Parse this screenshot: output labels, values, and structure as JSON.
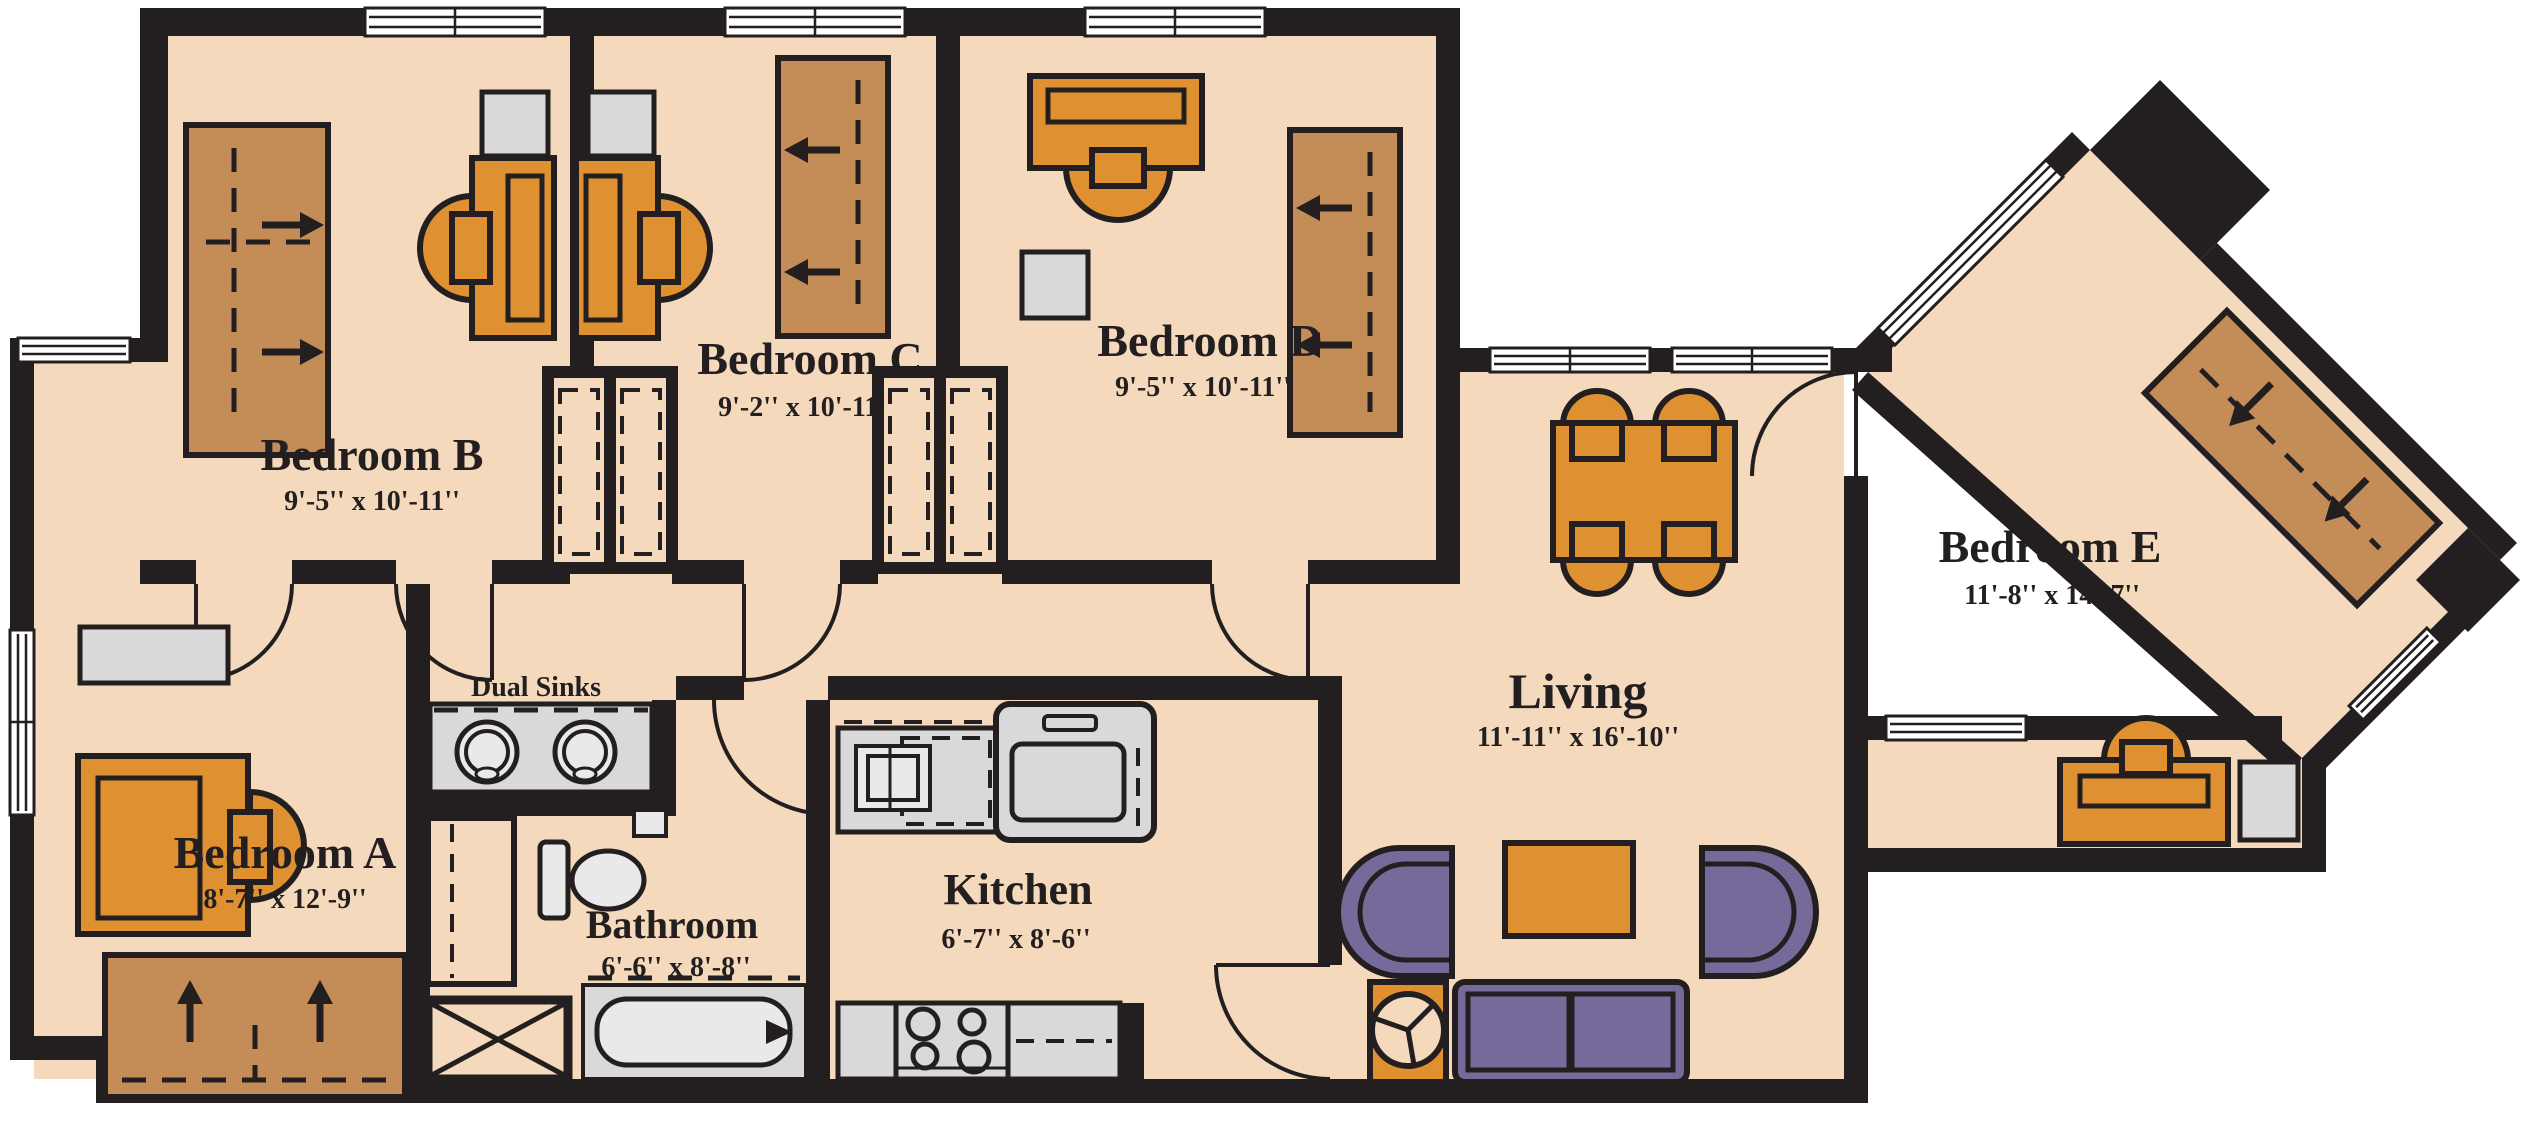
{
  "plan": {
    "type": "apartment-floor-plan",
    "rooms": [
      {
        "id": "bedroom-a",
        "name": "Bedroom A",
        "dims": "8'-7'' x 12'-9''"
      },
      {
        "id": "bedroom-b",
        "name": "Bedroom B",
        "dims": "9'-5'' x 10'-11''"
      },
      {
        "id": "bedroom-c",
        "name": "Bedroom C",
        "dims": "9'-2'' x 10'-11''"
      },
      {
        "id": "bedroom-d",
        "name": "Bedroom D",
        "dims": "9'-5'' x 10'-11''"
      },
      {
        "id": "bedroom-e",
        "name": "Bedroom E",
        "dims": "11'-8'' x 14'-7''"
      },
      {
        "id": "living",
        "name": "Living",
        "dims": "11'-11'' x 16'-10''"
      },
      {
        "id": "kitchen",
        "name": "Kitchen",
        "dims": "6'-7'' x 8'-6''"
      },
      {
        "id": "bathroom",
        "name": "Bathroom",
        "dims": "6'-6'' x 8'-8''"
      }
    ],
    "labels": {
      "dual_sinks": "Dual Sinks"
    }
  },
  "palette": {
    "background": "#ffffff",
    "floor": "#f4d9bd",
    "wall": "#231f20",
    "wood": "#df9132",
    "bed": "#c48c57",
    "upholstery": "#756a99",
    "fixture": "#d9d9d9",
    "fixture_light": "#e9e9e9"
  }
}
